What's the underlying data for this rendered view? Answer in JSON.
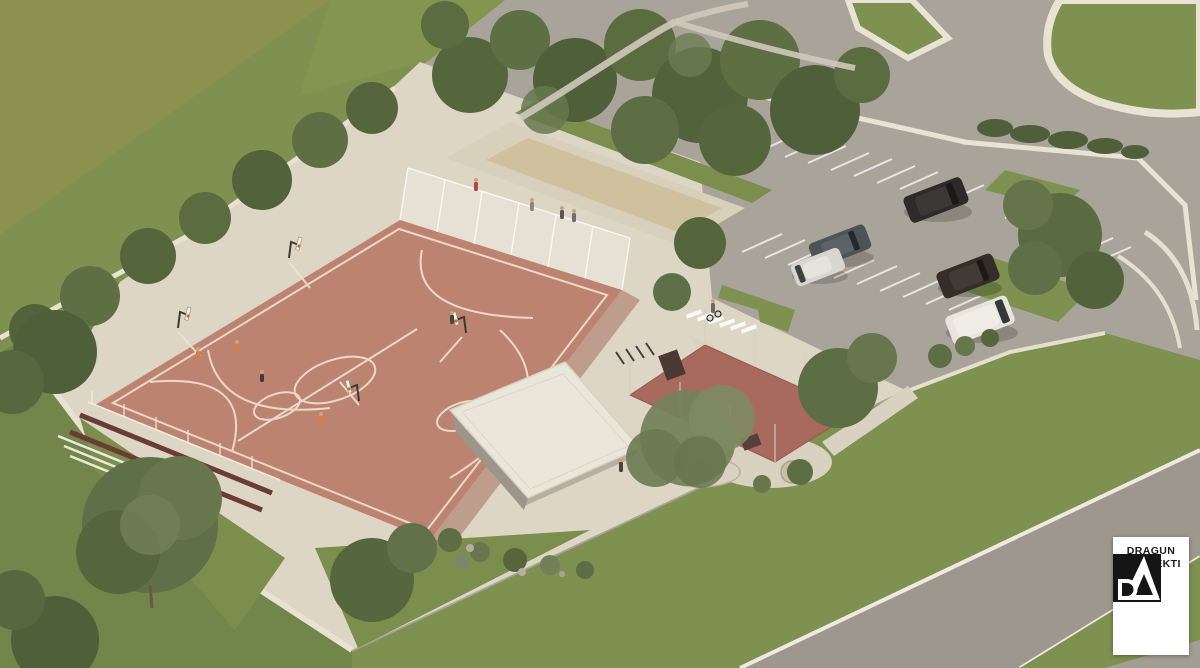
{
  "image": {
    "type": "architectural rendering",
    "view": "aerial isometric",
    "subject": "public sports park with basketball court, sand lanes, canopy pavilion, outdoor gym court and parking lot"
  },
  "logo": {
    "monogram": "DA",
    "line1": "DRAGUN",
    "line2": "ARHITEKTI"
  },
  "colors": {
    "court": "#bc8470",
    "court_line": "#f0e2d4",
    "grass": "#7e9150",
    "grass_olive": "#8f9150",
    "grass_dark": "#72854a",
    "foliage": "#55663c",
    "foliage_gray": "#75835c",
    "concrete": "#ddd6c5",
    "kerb": "#e9e3d3",
    "asphalt": "#a9a499",
    "road": "#9d978d",
    "sand": "#cfc09e",
    "roof": "#ebe6da",
    "red_paving": "#a86a5e",
    "bench": "#6a3c34",
    "car_black": "#2c2b29",
    "car_gray": "#4e5355",
    "car_white": "#d7d6d0",
    "car_brown": "#342d28",
    "van_white": "#e7e5dd",
    "logo_bg": "#ffffff",
    "logo_ink": "#151515"
  }
}
